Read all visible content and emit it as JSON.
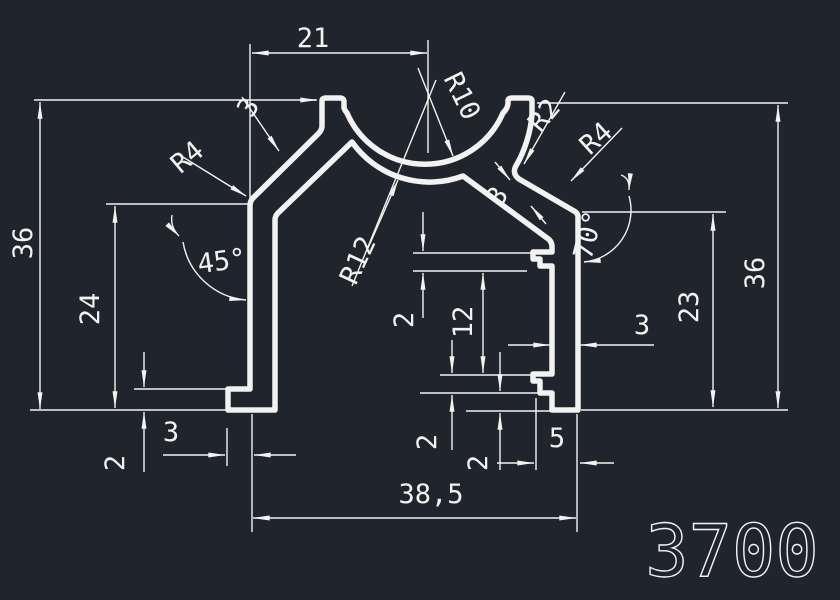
{
  "drawing": {
    "part_number": "3700",
    "colors": {
      "background": "#20242c",
      "line": "#f2f2f2"
    },
    "dimensions": {
      "top_width": "21",
      "overall_height_left": "36",
      "overall_height_right": "36",
      "left_wall_height": "24",
      "right_wall_height": "23",
      "overall_width": "38,5",
      "right_slot_height": "12",
      "right_foot_width": "5",
      "left_foot_width": "3",
      "right_wall_thickness": "3",
      "left_slope_thickness": "3",
      "right_slope_thickness": "3",
      "left_foot_height": "2",
      "upper_lip_height": "2",
      "lower_lip_height": "2",
      "right_foot_height": "2",
      "left_angle": "45°",
      "right_angle": "70°",
      "bowl_inner_radius": "R10",
      "bowl_outer_radius": "R12",
      "left_fillet_radius": "R4",
      "right_fillet_radius": "R4",
      "small_fillet_radius": "R2"
    }
  }
}
